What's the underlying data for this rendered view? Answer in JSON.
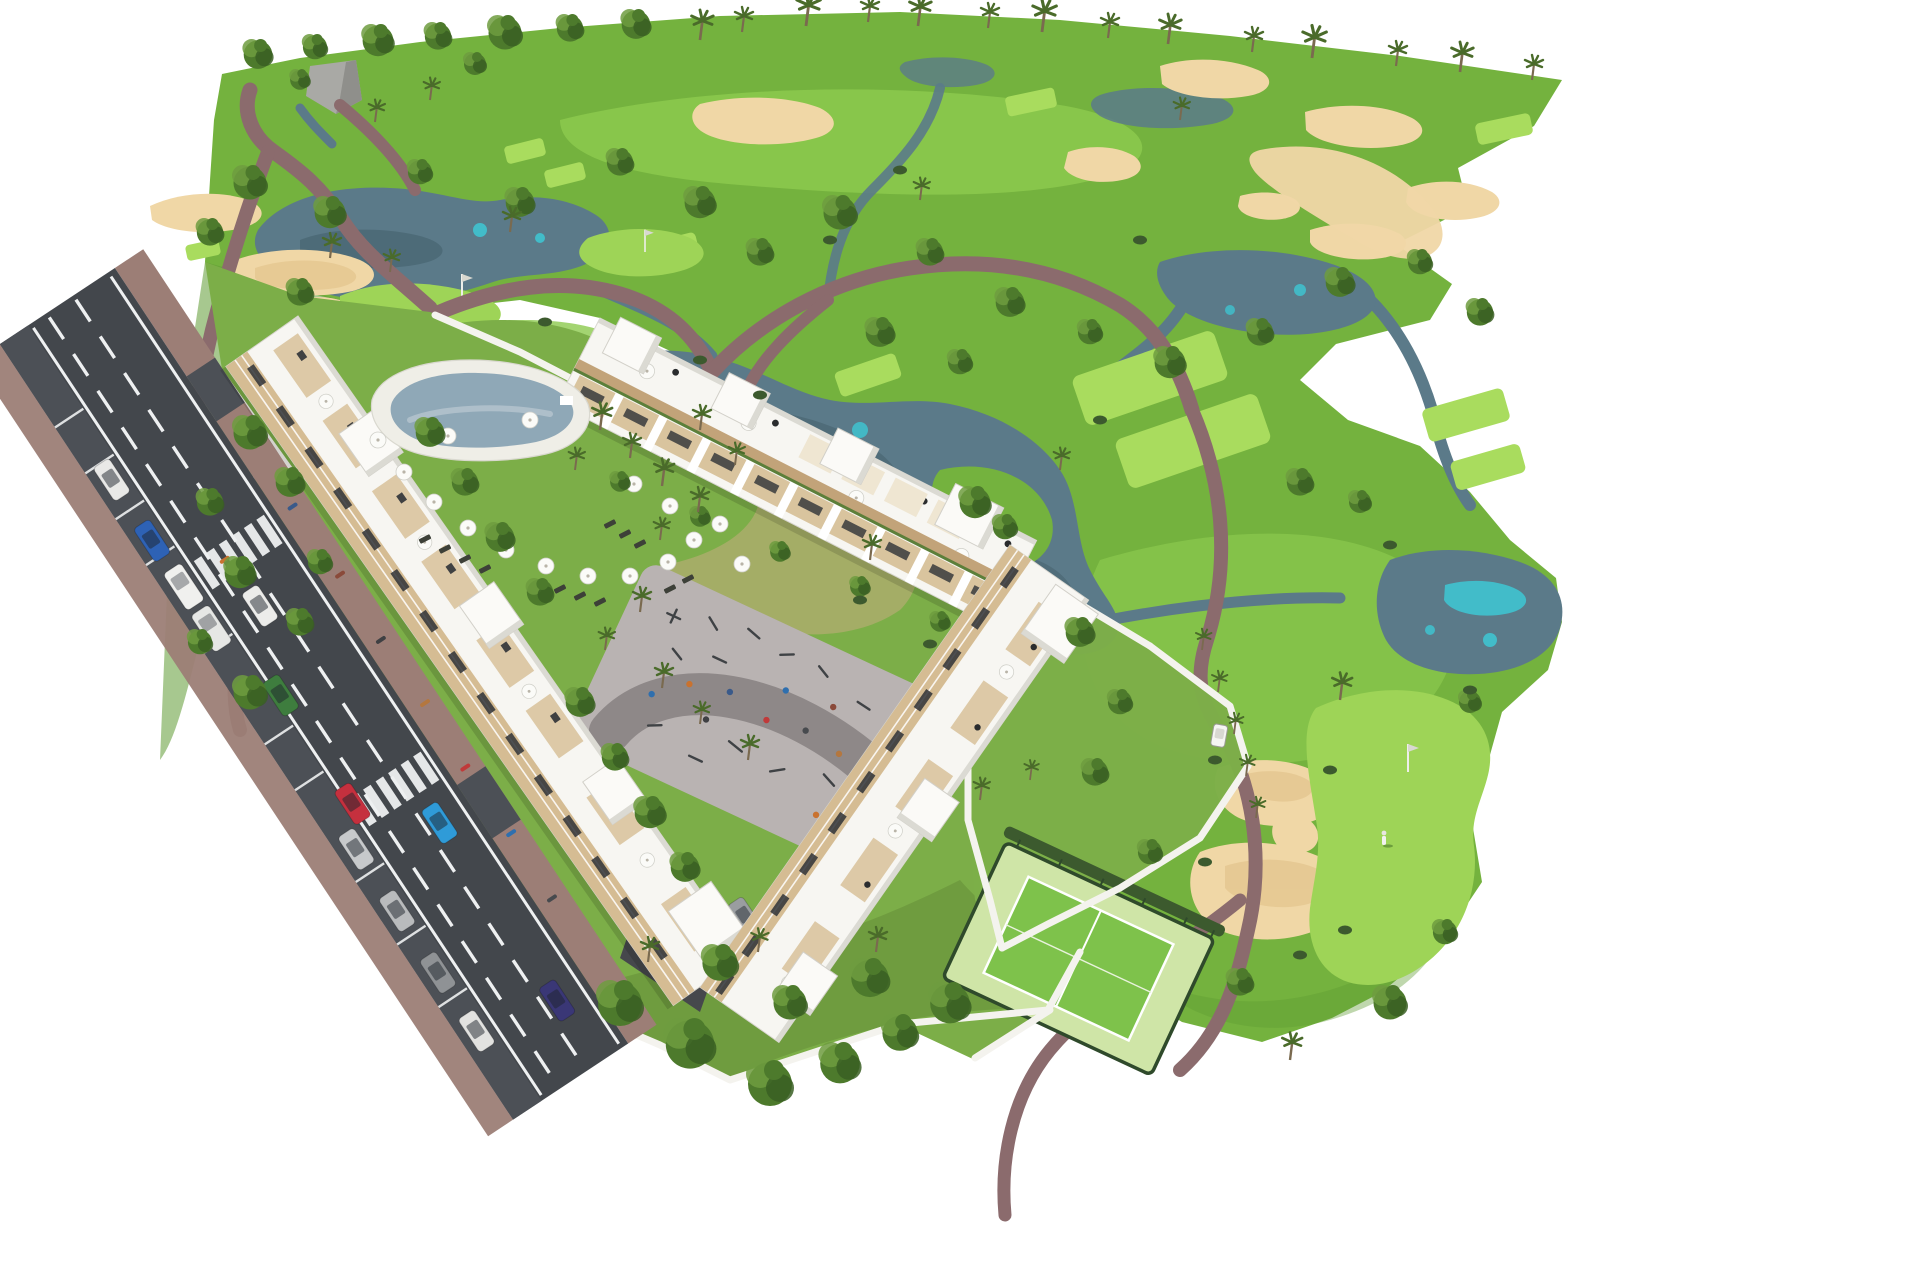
{
  "scene": {
    "type": "aerial-3d-architectural-render",
    "setting": "golf resort residential development with apartment blocks beside a golf course",
    "features": [
      "golf course with lakes, streams and sand bunkers",
      "three long white apartment blocks with rooftop terraces and tan balcony bands",
      "kidney-shaped swimming pool with white sun umbrellas and loungers",
      "outdoor gym and playground plaza with curved path",
      "fenced padel court",
      "access road with lane markings, zebra crossings, parked and moving cars",
      "putting green with flag and golfer",
      "golf cart on cart path",
      "palm trees and mediterranean landscaping",
      "white perimeter garden walls"
    ],
    "visible_text": []
  },
  "colors": {
    "bg": "#ffffff",
    "course_green": "#74b23e",
    "course_green_light": "#8cc94e",
    "course_green_dark": "#5e9a33",
    "tee_green": "#a9dc5e",
    "putting_green": "#9ed457",
    "resort_lawn": "#7cae48",
    "garden_green": "#6f9c3f",
    "dry_lawn": "#a9ad69",
    "tree_dark": "#3a5f23",
    "tree_mid": "#4d7a2c",
    "tree_light": "#6f9c3f",
    "palm_crown": "#4a6b2a",
    "palm_trunk": "#7a6a4f",
    "bush_green": "#3c5a2e",
    "sand": "#f0d7a6",
    "sand_shadow": "#e2c38b",
    "water_main": "#5b7a89",
    "water_dark": "#45606c",
    "water_teal": "#3fc3d0",
    "rock_gray": "#a9a9a5",
    "path_mauve": "#8b6b6d",
    "plaza_gray": "#b9b3b2",
    "plaza_band": "#8e8888",
    "road_asphalt": "#43474c",
    "road_lane": "#4c5056",
    "marking_white": "#eef0f1",
    "sidewalk_brick": "#9c7e76",
    "wall_white": "#f4f3ee",
    "building_white": "#f7f6f2",
    "building_shade": "#dbdad3",
    "facade_tan": "#d5bc93",
    "facade_wood": "#c2a379",
    "window_dark": "#2f3237",
    "terrace_tan": "#d9c49e",
    "umbrella_white": "#fbfbf8",
    "lounger_dark": "#3d4038",
    "pool_deck": "#efeee7",
    "pool_water": "#8fa8b7",
    "pool_water_light": "#aebfca",
    "court_green": "#7ec24b",
    "court_surround": "#cfe5a7",
    "fence_green": "#2f4a2b",
    "hedge_green": "#3c5a2e",
    "flag_white": "#eeeeea"
  },
  "road": {
    "crosswalk_count": 2,
    "lanes": 2,
    "parking_lane": true
  },
  "cars": [
    {
      "name": "parked-car-white",
      "color": "#e9e9e7"
    },
    {
      "name": "parked-car-blue",
      "color": "#2e62b5"
    },
    {
      "name": "parked-van-white-1",
      "color": "#f0f0ee"
    },
    {
      "name": "parked-van-white-2",
      "color": "#e6e7e5"
    },
    {
      "name": "parked-car-silver-1",
      "color": "#c7c9cb"
    },
    {
      "name": "parked-car-silver-2",
      "color": "#b9bbbd"
    },
    {
      "name": "parked-car-gray",
      "color": "#8f9295"
    },
    {
      "name": "parked-car-white-2",
      "color": "#e2e2e0"
    },
    {
      "name": "driving-car-white",
      "color": "#ececea"
    },
    {
      "name": "driving-car-green",
      "color": "#3e7d3e"
    },
    {
      "name": "driving-car-red",
      "color": "#c5303e"
    },
    {
      "name": "driving-car-azure",
      "color": "#2f9bd8"
    },
    {
      "name": "driving-car-navy",
      "color": "#3a3776"
    },
    {
      "name": "courtyard-car-gray",
      "color": "#9a9da0"
    },
    {
      "name": "golf-cart",
      "color": "#f5f5f2"
    }
  ],
  "people_palette": [
    "#c9722f",
    "#8a4a3a",
    "#3a5a8a",
    "#3f4043",
    "#b4773f",
    "#c03a3a",
    "#2f6fae",
    "#474a4e"
  ],
  "golf": {
    "flags": 3,
    "golfers_on_green": 1
  }
}
